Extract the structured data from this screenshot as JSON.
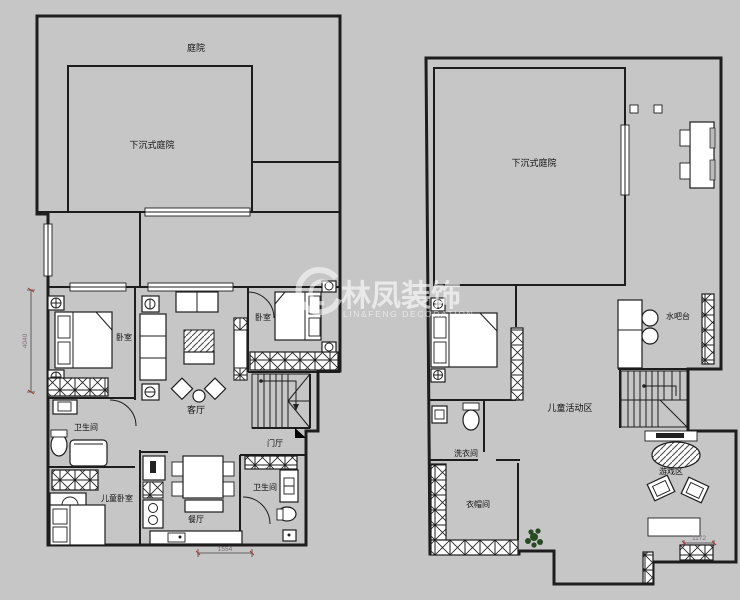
{
  "watermark": {
    "title": "林凤装饰",
    "subtitle": "LIN&FENG DECORATION"
  },
  "left_plan": {
    "rooms": {
      "courtyard": "庭院",
      "sunken_courtyard": "下沉式庭院",
      "bedroom_left": "卧室",
      "bedroom_right": "卧室",
      "living_room": "客厅",
      "bathroom_upper": "卫生间",
      "kids_bedroom": "儿童卧室",
      "dining_room": "餐厅",
      "entry_hall": "门厅",
      "bathroom_lower": "卫生间"
    },
    "dimensions": {
      "left": "4040",
      "bottom": "1554"
    }
  },
  "right_plan": {
    "rooms": {
      "sunken_courtyard": "下沉式庭院",
      "water_bar": "水吧台",
      "kids_activity_area": "儿童活动区",
      "laundry_room": "洗衣间",
      "cloakroom": "衣帽间",
      "game_area": "游戏区"
    },
    "dimensions": {
      "bottom_right": "1172"
    }
  },
  "colors": {
    "background": "#c6c6c6",
    "wall": "#1d1d1d",
    "dimension_tick": "#b03030"
  }
}
